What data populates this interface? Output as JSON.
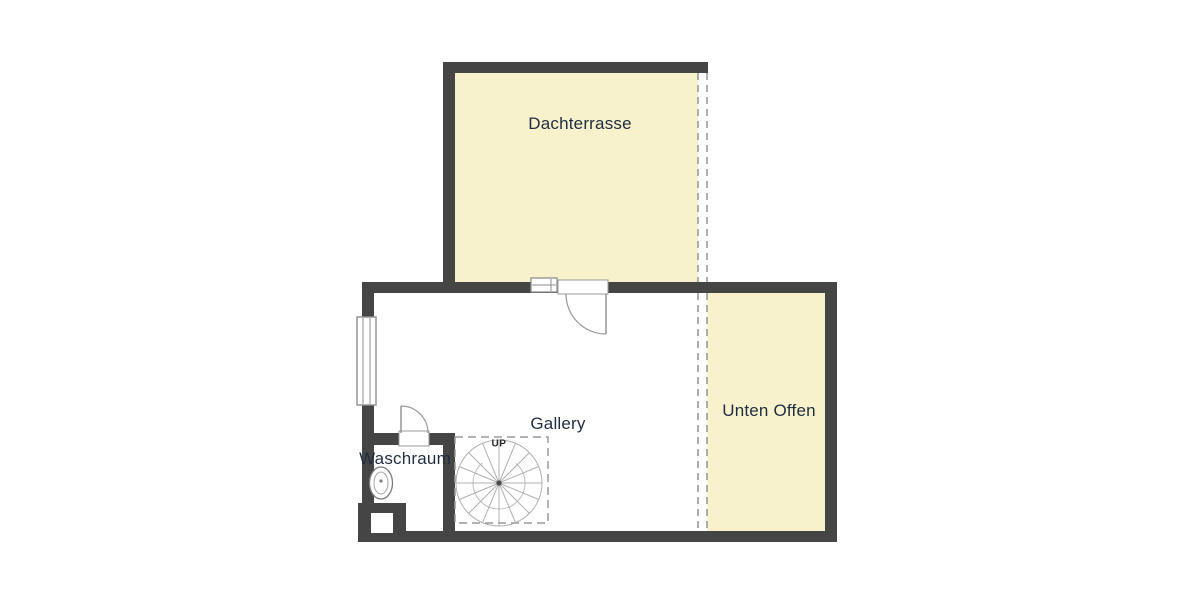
{
  "rooms": {
    "dachterrasse": {
      "label": "Dachterrasse"
    },
    "gallery": {
      "label": "Gallery"
    },
    "waschraum": {
      "label": "Waschraum"
    },
    "unten_offen": {
      "label": "Unten Offen"
    }
  },
  "stair": {
    "direction_label": "UP"
  },
  "colors": {
    "wall": "#454545",
    "open_area_fill": "#f7f1cc",
    "label_text": "#1f2d42",
    "dashed_open_edge": "#9a9a9a",
    "stair_lines": "#b0b0b0",
    "symbol_outline": "#8f8f8f"
  }
}
